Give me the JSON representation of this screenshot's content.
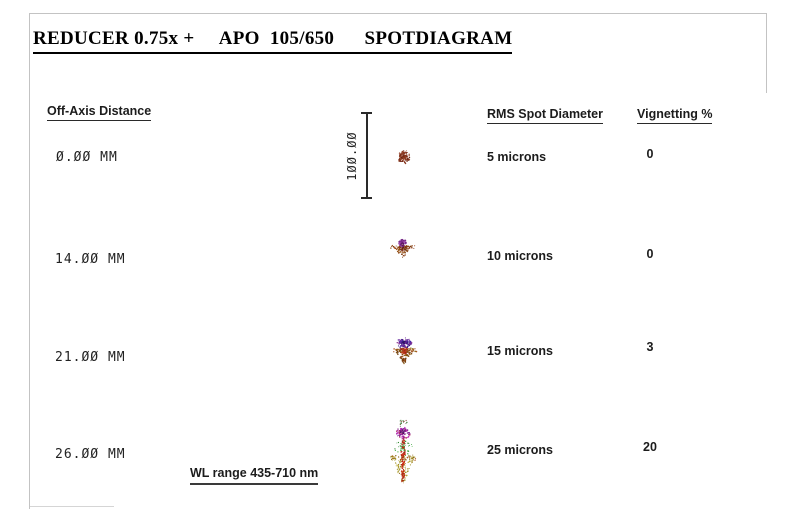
{
  "page": {
    "title": "REDUCER 0.75x +     APO  105/650      SPOTDIAGRAM"
  },
  "columns": {
    "off_axis": "Off-Axis Distance",
    "rms": "RMS Spot Diameter",
    "vignetting": "Vignetting %"
  },
  "scale_bar": {
    "label": "100.00"
  },
  "rows": [
    {
      "off_axis": "0.00 MM",
      "rms": "5 microns",
      "vignetting": "0"
    },
    {
      "off_axis": "14.00 MM",
      "rms": "10 microns",
      "vignetting": "0"
    },
    {
      "off_axis": "21.00 MM",
      "rms": "15 microns",
      "vignetting": "3"
    },
    {
      "off_axis": "26.00 MM",
      "rms": "25 microns",
      "vignetting": "20"
    }
  ],
  "footer": {
    "wl_range": "WL range 435-710 nm"
  },
  "colors": {
    "frame": "#c3c3c3",
    "text": "#1c1c1c",
    "spot_row1_core": "#7a2a18",
    "spot_purple_cap": "#7b2fa0",
    "spot_red_core": "#c22812",
    "spot_olive": "#9b8b20",
    "spot_green": "#2e8b2e"
  },
  "spots": [
    {
      "width": 16,
      "height": 16,
      "seed": 11,
      "layers": [
        {
          "type": "ellipse",
          "cx": 8,
          "cy": 8,
          "rx": 5.8,
          "ry": 6.2,
          "n": 110,
          "bias": 0.65,
          "colors": [
            "#7a2a18",
            "#8c3a20",
            "#61200f",
            "#944028"
          ],
          "rmin": 0.5,
          "rmax": 0.95
        },
        {
          "type": "ellipse",
          "cx": 8,
          "cy": 8,
          "rx": 6.8,
          "ry": 7.2,
          "n": 18,
          "bias": 0.9,
          "colors": [
            "#9a4a2e",
            "#8c3a20"
          ],
          "rmin": 0.4,
          "rmax": 0.7
        }
      ]
    },
    {
      "width": 28,
      "height": 26,
      "seed": 22,
      "layers": [
        {
          "type": "tri",
          "pts": [
            [
              4,
              8
            ],
            [
              24,
              8
            ],
            [
              14,
              20
            ]
          ],
          "n": 60,
          "colors": [
            "#8b4513",
            "#7b3a10",
            "#934d0a",
            "#a0522d"
          ],
          "rmin": 0.5,
          "rmax": 0.9
        },
        {
          "type": "hband",
          "cx": 14,
          "cy": 9,
          "halfw": 12.5,
          "spread": 1.6,
          "n": 26,
          "colors": [
            "#a5401d",
            "#b05520",
            "#8b4513",
            "#7b3a10"
          ],
          "rmin": 0.4,
          "rmax": 0.8
        },
        {
          "type": "ellipse",
          "cx": 14,
          "cy": 10,
          "rx": 3,
          "ry": 3,
          "n": 25,
          "bias": 0.6,
          "colors": [
            "#5f2010",
            "#7a2a18"
          ],
          "rmin": 0.5,
          "rmax": 0.9
        },
        {
          "type": "ellipse",
          "cx": 14,
          "cy": 5,
          "rx": 4.6,
          "ry": 3.6,
          "n": 55,
          "bias": 0.6,
          "colors": [
            "#8b2fa0",
            "#7b2d8e",
            "#6a1b7a",
            "#9a3aa8"
          ],
          "rmin": 0.5,
          "rmax": 0.9
        },
        {
          "type": "ellipse",
          "cx": 14,
          "cy": 5.5,
          "rx": 2.2,
          "ry": 1.8,
          "n": 12,
          "bias": 0.8,
          "colors": [
            "#55124f",
            "#6a1b7a"
          ],
          "rmin": 0.4,
          "rmax": 0.7
        }
      ]
    },
    {
      "width": 28,
      "height": 32,
      "seed": 33,
      "layers": [
        {
          "type": "tri",
          "pts": [
            [
              3,
              13
            ],
            [
              25,
              13
            ],
            [
              14,
              28
            ]
          ],
          "n": 85,
          "colors": [
            "#8b5a13",
            "#7b4a10",
            "#9b6a14",
            "#a0522d",
            "#6b3a0a"
          ],
          "rmin": 0.5,
          "rmax": 0.95
        },
        {
          "type": "hband",
          "cx": 14,
          "cy": 14,
          "halfw": 12.5,
          "spread": 2,
          "n": 30,
          "colors": [
            "#a0522d",
            "#8b6914",
            "#b05520"
          ],
          "rmin": 0.4,
          "rmax": 0.8
        },
        {
          "type": "ellipse",
          "cx": 14,
          "cy": 14,
          "rx": 3.2,
          "ry": 5,
          "n": 40,
          "bias": 0.6,
          "colors": [
            "#b53020",
            "#c23a1a",
            "#992818"
          ],
          "rmin": 0.5,
          "rmax": 0.95
        },
        {
          "type": "ellipse",
          "cx": 14,
          "cy": 7,
          "rx": 7.6,
          "ry": 5.2,
          "n": 90,
          "bias": 0.6,
          "colors": [
            "#5b2da0",
            "#7b2fa0",
            "#4a25a8",
            "#8b2d8e",
            "#3a1a88"
          ],
          "rmin": 0.5,
          "rmax": 0.95
        },
        {
          "type": "ellipse",
          "cx": 14,
          "cy": 7,
          "rx": 3,
          "ry": 2.6,
          "n": 15,
          "bias": 0.8,
          "colors": [
            "#2d1560",
            "#45108a"
          ],
          "rmin": 0.4,
          "rmax": 0.75
        },
        {
          "type": "ellipse",
          "cx": 14,
          "cy": 24,
          "rx": 2,
          "ry": 3.5,
          "n": 15,
          "bias": 0.7,
          "colors": [
            "#8b3a10",
            "#6b3a0a"
          ],
          "rmin": 0.4,
          "rmax": 0.8
        }
      ]
    },
    {
      "width": 30,
      "height": 70,
      "seed": 44,
      "layers": [
        {
          "type": "ellipse",
          "cx": 15,
          "cy": 5,
          "rx": 4.5,
          "ry": 4,
          "n": 14,
          "bias": 0.8,
          "colors": [
            "#2e7b2e",
            "#7a2a18",
            "#555533"
          ],
          "rmin": 0.4,
          "rmax": 0.75
        },
        {
          "type": "ellipse",
          "cx": 15,
          "cy": 30,
          "rx": 9.5,
          "ry": 8,
          "n": 50,
          "bias": 0.85,
          "colors": [
            "#2e8b2e",
            "#3aa33a",
            "#1e7a1e",
            "#4ab34a"
          ],
          "rmin": 0.4,
          "rmax": 0.8
        },
        {
          "type": "tri",
          "pts": [
            [
              2,
              38
            ],
            [
              28,
              38
            ],
            [
              15,
              66
            ]
          ],
          "n": 130,
          "colors": [
            "#9b8b20",
            "#b0a030",
            "#8b6914",
            "#a0922a",
            "#c2b040"
          ],
          "rmin": 0.4,
          "rmax": 0.8
        },
        {
          "type": "hband",
          "cx": 15,
          "cy": 40,
          "halfw": 13,
          "spread": 3,
          "n": 30,
          "colors": [
            "#9b8b20",
            "#b05520",
            "#8b6914"
          ],
          "rmin": 0.4,
          "rmax": 0.75
        },
        {
          "type": "ellipse",
          "cx": 15,
          "cy": 38,
          "rx": 2.6,
          "ry": 20,
          "n": 80,
          "bias": 0.7,
          "colors": [
            "#c22812",
            "#a82010",
            "#d23a1a"
          ],
          "rmin": 0.45,
          "rmax": 0.9
        },
        {
          "type": "ellipse",
          "cx": 15,
          "cy": 15,
          "rx": 7.2,
          "ry": 6,
          "n": 85,
          "bias": 0.6,
          "colors": [
            "#a020a0",
            "#c030c0",
            "#8b2d8e",
            "#b03060",
            "#7a1b8e"
          ],
          "rmin": 0.5,
          "rmax": 0.95
        },
        {
          "type": "ellipse",
          "cx": 15,
          "cy": 15,
          "rx": 3.2,
          "ry": 3,
          "n": 16,
          "bias": 0.8,
          "colors": [
            "#4a1060",
            "#6a1b7a"
          ],
          "rmin": 0.4,
          "rmax": 0.75
        },
        {
          "type": "ellipse",
          "cx": 15,
          "cy": 60,
          "rx": 1.8,
          "ry": 6,
          "n": 22,
          "bias": 0.7,
          "colors": [
            "#c22812",
            "#a82010"
          ],
          "rmin": 0.4,
          "rmax": 0.8
        }
      ]
    }
  ],
  "chart_data": {
    "type": "table",
    "title": "REDUCER 0.75x + APO 105/650 SPOTDIAGRAM",
    "columns": [
      "Off-Axis Distance",
      "RMS Spot Diameter",
      "Vignetting %"
    ],
    "rows": [
      [
        "0.00 MM",
        "5 microns",
        "0"
      ],
      [
        "14.00 MM",
        "10 microns",
        "0"
      ],
      [
        "21.00 MM",
        "15 microns",
        "3"
      ],
      [
        "26.00 MM",
        "25 microns",
        "20"
      ]
    ],
    "off_axis_mm": [
      0,
      14,
      21,
      26
    ],
    "rms_spot_microns": [
      5,
      10,
      15,
      25
    ],
    "vignetting_percent": [
      0,
      0,
      3,
      20
    ],
    "scale_bar_microns": 100,
    "scale_bar_label": "100.00",
    "wavelength_range_nm": [
      435,
      710
    ],
    "wavelength_note": "WL range 435-710 nm"
  }
}
